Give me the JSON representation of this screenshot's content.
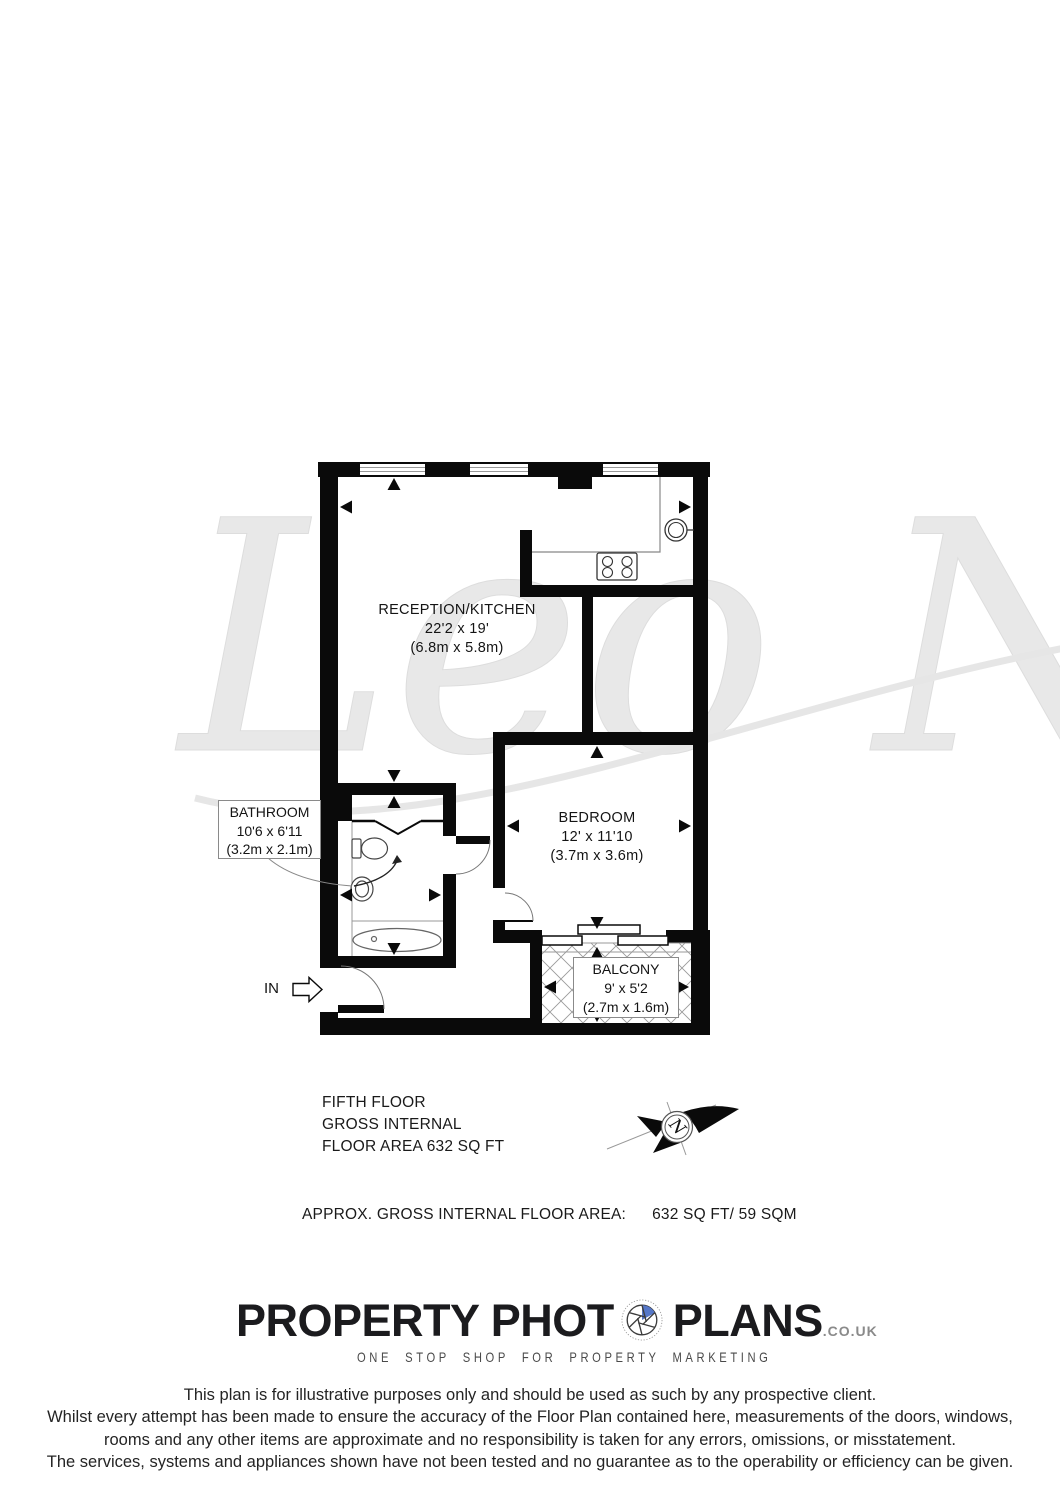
{
  "watermark_text": "Leo New",
  "plan": {
    "rooms": [
      {
        "id": "reception",
        "name": "RECEPTION/KITCHEN",
        "dims_imperial": "22'2 x 19'",
        "dims_metric": "(6.8m x 5.8m)"
      },
      {
        "id": "bedroom",
        "name": "BEDROOM",
        "dims_imperial": "12' x 11'10",
        "dims_metric": "(3.7m x 3.6m)"
      },
      {
        "id": "bathroom",
        "name": "BATHROOM",
        "dims_imperial": "10'6 x 6'11",
        "dims_metric": "(3.2m x 2.1m)"
      },
      {
        "id": "balcony",
        "name": "BALCONY",
        "dims_imperial": "9' x 5'2",
        "dims_metric": "(2.7m x 1.6m)"
      }
    ],
    "entrance_label": "IN",
    "compass_label": "N"
  },
  "floor_info": {
    "line1": "FIFTH FLOOR",
    "line2": "GROSS INTERNAL",
    "line3": "FLOOR AREA 632 SQ FT"
  },
  "area_summary": {
    "label": "APPROX. GROSS INTERNAL FLOOR AREA:",
    "value": "632 SQ FT/  59 SQM"
  },
  "branding": {
    "logo_part1": "PROPERTY PHOT",
    "logo_part2": "PLANS",
    "logo_suffix": ".CO.UK",
    "tagline": "ONE STOP SHOP FOR PROPERTY MARKETING"
  },
  "disclaimer": {
    "line1": "This plan is for illustrative purposes only and should be used as such by any prospective client.",
    "line2": "Whilst every attempt has been made to ensure the accuracy of the Floor Plan contained here, measurements of the doors, windows,",
    "line3": "rooms and any other items are approximate and no responsibility is taken for any errors, omissions, or misstatement.",
    "line4": "The services, systems and appliances shown have not been tested and no guarantee as to the operability or efficiency can be given."
  },
  "colors": {
    "wall": "#0a0a0a",
    "accent_blue": "#5577c8",
    "watermark": "#e8e8e8",
    "label_border": "#8a8a8a"
  }
}
